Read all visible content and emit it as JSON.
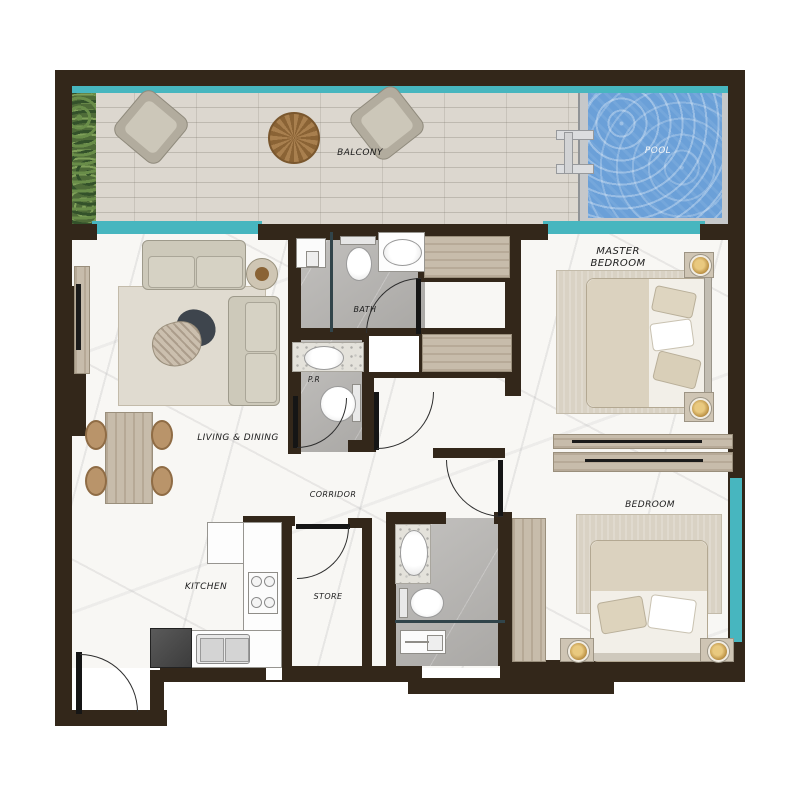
{
  "plan_title": "apartment-floor-plan",
  "rooms": {
    "balcony": {
      "label": "BALCONY"
    },
    "pool": {
      "label": "POOL"
    },
    "master_bedroom": {
      "label": "MASTER BEDROOM"
    },
    "bath": {
      "label": "BATH"
    },
    "powder_room": {
      "label": "P.R"
    },
    "living_dining": {
      "label": "LIVING & DINING"
    },
    "corridor": {
      "label": "CORRIDOR"
    },
    "kitchen": {
      "label": "KITCHEN"
    },
    "store": {
      "label": "STORE"
    },
    "bedroom": {
      "label": "BEDROOM"
    }
  },
  "colors": {
    "wall": "#33271a",
    "window_teal": "#47b6bf",
    "pool_water": "#6ba0d8",
    "deck_wood": "#dcd7cf",
    "marble_floor": "#f8f7f4",
    "tile_gray": "#b4b2af",
    "furniture_wood": "#c7bcab",
    "plant_green": "#4e6b38"
  }
}
